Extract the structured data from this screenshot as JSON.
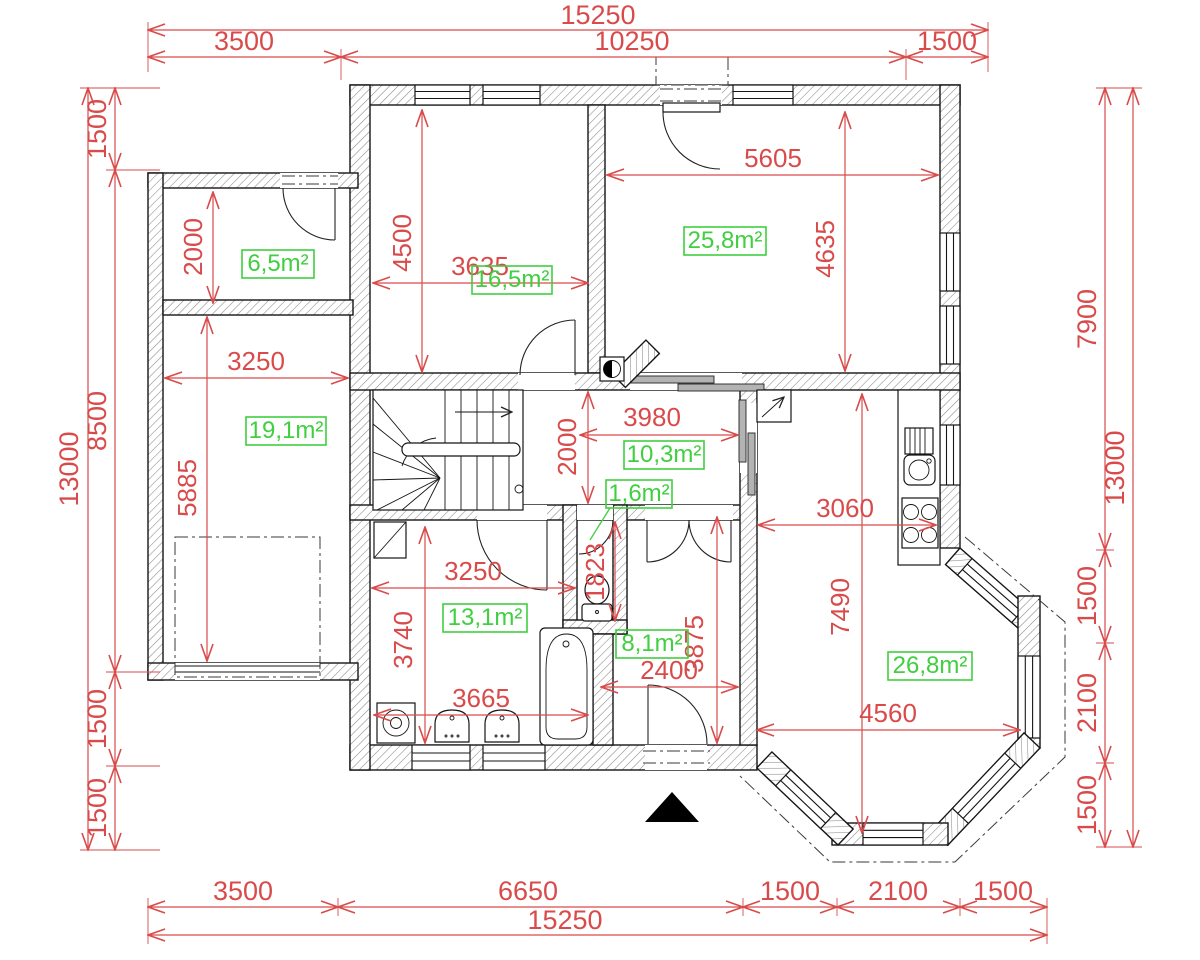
{
  "meta": {
    "drawing_type": "floor-plan",
    "background": "#ffffff",
    "dimension_color": "#d94b4b",
    "area_label_color": "#3fcf3f",
    "wall_color": "#151515"
  },
  "dims_outer": {
    "top_total": "15250",
    "top_seg1": "3500",
    "top_seg2": "10250",
    "top_seg3": "1500",
    "bottom_seg1": "3500",
    "bottom_seg2": "6650",
    "bottom_seg3": "1500",
    "bottom_seg4": "2100",
    "bottom_seg5": "1500",
    "bottom_total": "15250",
    "left_total": "13000",
    "left_seg1": "1500",
    "left_seg2": "8500",
    "left_seg3": "1500",
    "left_seg4": "1500",
    "right_seg1": "7900",
    "right_seg2": "1500",
    "right_seg3": "2100",
    "right_seg4": "1500",
    "right_total": "13000"
  },
  "dims_inner": {
    "storage_h": "2000",
    "garage_w": "3250",
    "garage_h": "5885",
    "bed1_w": "3635",
    "bed1_h": "4500",
    "bed2_w": "5605",
    "bed2_h": "4635",
    "hall_w": "3980",
    "hall_h": "2000",
    "wc_h": "1823",
    "bath_w": "3250",
    "bath_h": "3740",
    "bath_w2": "3665",
    "entry_h": "3875",
    "entry_w": "2400",
    "kitchen_w": "3060",
    "living_h": "7490",
    "living_w": "4560"
  },
  "areas": {
    "storage": "6,5m²",
    "bed1": "16,5m²",
    "bed2": "25,8m²",
    "garage": "19,1m²",
    "hall": "10,3m²",
    "wc": "1,6m²",
    "bath": "13,1m²",
    "entry": "8,1m²",
    "living": "26,8m²"
  }
}
